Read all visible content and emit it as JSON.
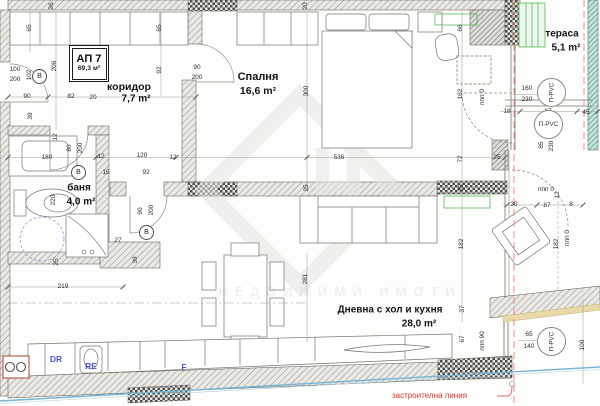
{
  "apartment_box": {
    "code": "АП 7",
    "area": "69,3 м²"
  },
  "rooms": {
    "corridor": {
      "name": "коридор",
      "area": "7,7 m²"
    },
    "bedroom": {
      "name": "Спалня",
      "area": "16,6 m²"
    },
    "terrace": {
      "name": "тераса",
      "area": "5,1 m²"
    },
    "bath": {
      "name": "баня",
      "area": "4,0 m²"
    },
    "living": {
      "name": "Дневна с хол и кухня",
      "area": "28,0 m²"
    }
  },
  "kitchen": {
    "dr": "DR",
    "re": "RE",
    "f": "F"
  },
  "window_label": "П-PVC",
  "door_label": "В",
  "building_line_label": "застроителна линия",
  "watermark_text": "НЕДВИЖИМИ ИМОТИ",
  "colors": {
    "wall_hatch": "#8f8f8a",
    "checker": "#4e4e4a",
    "red_line": "#f08a8a",
    "blue_line": "#79b4d6",
    "green_accent": "#3fae49",
    "label_red": "#d93434"
  },
  "windows": [
    {
      "x": 551,
      "y": 92,
      "rot": 1
    },
    {
      "x": 548,
      "y": 124,
      "rot": 0
    },
    {
      "x": 551,
      "y": 341,
      "rot": 1
    }
  ],
  "door_letters": [
    {
      "x": 39,
      "y": 76
    },
    {
      "x": 78,
      "y": 172
    },
    {
      "x": 146,
      "y": 232
    }
  ],
  "dimensions": [
    {
      "t": "26",
      "x": 52,
      "y": 6,
      "r": 1
    },
    {
      "t": "65",
      "x": 30,
      "y": 28,
      "r": 1
    },
    {
      "t": "65",
      "x": 160,
      "y": 28,
      "r": 1
    },
    {
      "t": "20",
      "x": 306,
      "y": 6,
      "r": 1
    },
    {
      "t": "100",
      "x": 15,
      "y": 70
    },
    {
      "t": "200",
      "x": 15,
      "y": 80
    },
    {
      "t": "102",
      "x": 30,
      "y": 75,
      "r": 1
    },
    {
      "t": "206",
      "x": 55,
      "y": 66,
      "r": 1
    },
    {
      "t": "90",
      "x": 27,
      "y": 97
    },
    {
      "t": "82",
      "x": 71,
      "y": 97
    },
    {
      "t": "20",
      "x": 93,
      "y": 98
    },
    {
      "t": "92",
      "x": 160,
      "y": 70,
      "r": 1
    },
    {
      "t": "90",
      "x": 197,
      "y": 68
    },
    {
      "t": "200",
      "x": 197,
      "y": 78
    },
    {
      "t": "39",
      "x": 31,
      "y": 116,
      "r": 1
    },
    {
      "t": "300",
      "x": 307,
      "y": 91,
      "r": 1
    },
    {
      "t": "66",
      "x": 461,
      "y": 28,
      "r": 1
    },
    {
      "t": "162",
      "x": 461,
      "y": 94,
      "r": 1
    },
    {
      "t": "ппп 0",
      "x": 483,
      "y": 97,
      "r": 1
    },
    {
      "t": "160",
      "x": 527,
      "y": 89
    },
    {
      "t": "230",
      "x": 527,
      "y": 100
    },
    {
      "t": "18",
      "x": 507,
      "y": 112
    },
    {
      "t": "87",
      "x": 548,
      "y": 112
    },
    {
      "t": "45",
      "x": 586,
      "y": 113
    },
    {
      "t": "85",
      "x": 542,
      "y": 145,
      "r": 1
    },
    {
      "t": "230",
      "x": 552,
      "y": 146,
      "r": 1
    },
    {
      "t": "12",
      "x": 56,
      "y": 137,
      "r": 1
    },
    {
      "t": "180",
      "x": 47,
      "y": 158
    },
    {
      "t": "80",
      "x": 70,
      "y": 148,
      "r": 1
    },
    {
      "t": "200",
      "x": 81,
      "y": 148,
      "r": 1
    },
    {
      "t": "12",
      "x": 101,
      "y": 157
    },
    {
      "t": "120",
      "x": 142,
      "y": 156
    },
    {
      "t": "15",
      "x": 106,
      "y": 173
    },
    {
      "t": "92",
      "x": 146,
      "y": 173
    },
    {
      "t": "12",
      "x": 173,
      "y": 158
    },
    {
      "t": "536",
      "x": 339,
      "y": 158
    },
    {
      "t": "25",
      "x": 497,
      "y": 158
    },
    {
      "t": "72",
      "x": 461,
      "y": 159,
      "r": 1
    },
    {
      "t": "220",
      "x": 54,
      "y": 200,
      "r": 1
    },
    {
      "t": "90",
      "x": 141,
      "y": 211,
      "r": 1
    },
    {
      "t": "200",
      "x": 152,
      "y": 210,
      "r": 1
    },
    {
      "t": "25",
      "x": 307,
      "y": 188,
      "r": 1
    },
    {
      "t": "25",
      "x": 462,
      "y": 188,
      "r": 1
    },
    {
      "t": "ппп 0",
      "x": 546,
      "y": 190
    },
    {
      "t": "12",
      "x": 558,
      "y": 195,
      "r": 1
    },
    {
      "t": "30",
      "x": 514,
      "y": 205
    },
    {
      "t": "87",
      "x": 547,
      "y": 206
    },
    {
      "t": "8",
      "x": 571,
      "y": 205
    },
    {
      "t": "27",
      "x": 118,
      "y": 241
    },
    {
      "t": "39",
      "x": 136,
      "y": 260,
      "r": 1
    },
    {
      "t": "25",
      "x": 57,
      "y": 262,
      "r": 1
    },
    {
      "t": "182",
      "x": 462,
      "y": 244,
      "r": 1
    },
    {
      "t": "182",
      "x": 557,
      "y": 244,
      "r": 1
    },
    {
      "t": "ппп 0",
      "x": 568,
      "y": 238,
      "r": 1
    },
    {
      "t": "219",
      "x": 63,
      "y": 287
    },
    {
      "t": "281",
      "x": 306,
      "y": 279,
      "r": 1
    },
    {
      "t": "37",
      "x": 463,
      "y": 309,
      "r": 1
    },
    {
      "t": "67",
      "x": 463,
      "y": 339,
      "r": 1
    },
    {
      "t": "ппп 90",
      "x": 483,
      "y": 341,
      "r": 1
    },
    {
      "t": "65",
      "x": 529,
      "y": 335
    },
    {
      "t": "140",
      "x": 529,
      "y": 347
    },
    {
      "t": "100",
      "x": 583,
      "y": 345,
      "r": 1
    }
  ]
}
